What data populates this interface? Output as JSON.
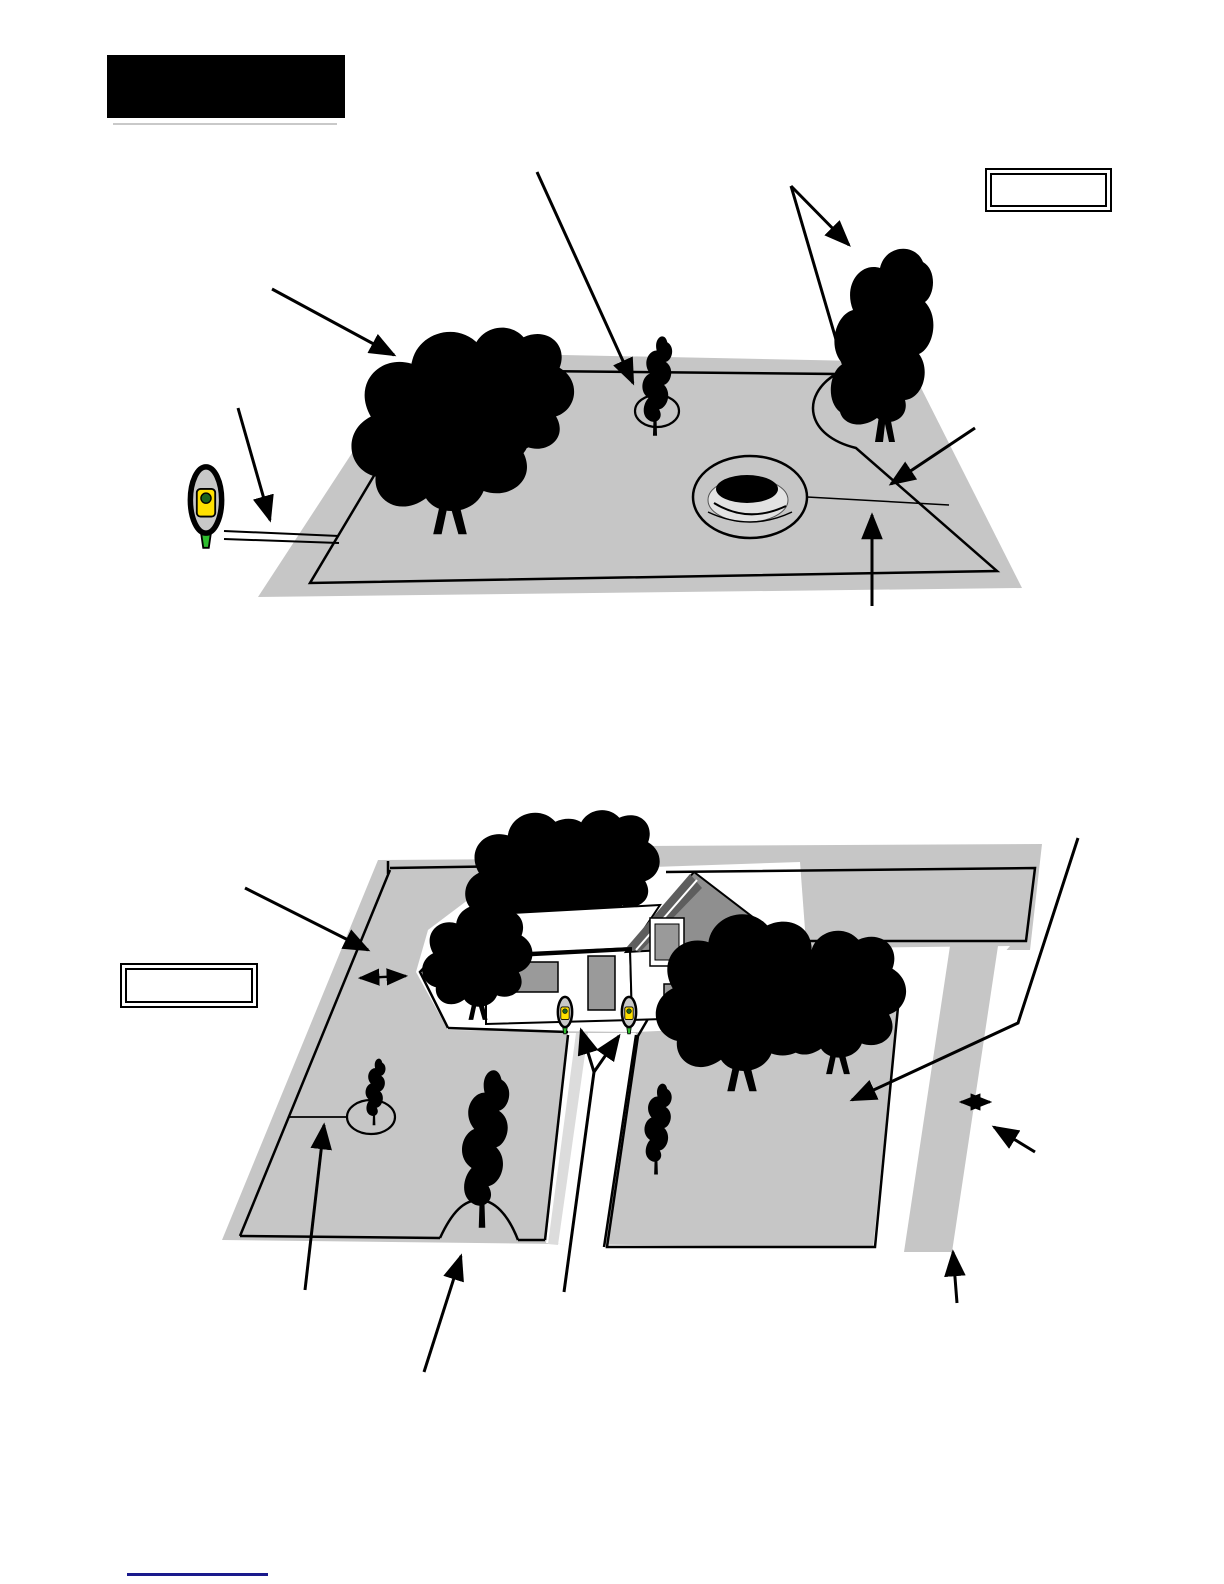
{
  "page": {
    "width": 1224,
    "height": 1584,
    "background": "#ffffff"
  },
  "header": {
    "label": "",
    "background": "#000000"
  },
  "callouts": {
    "upper_right": "",
    "mid_left": ""
  },
  "footer": {
    "rule_color": "#1a1a8c"
  },
  "colors": {
    "lawn_gray": "#c6c6c6",
    "outline_black": "#000000",
    "station_body_yellow": "#ffe000",
    "station_stake_green": "#2ebd2e",
    "station_dot_green": "#1c641c",
    "station_cap_gray": "#c8c8c8",
    "house_wall_white": "#ffffff",
    "gable_gray": "#8f8f8f",
    "roof_edge_dark": "#5e5e5e",
    "window_gray": "#9a9a9a",
    "driveway_stripe": "#dcdcdc",
    "tree_black": "#000000"
  },
  "upper_diagram": {
    "name": "open-lawn-perimeter-wire",
    "elements": [
      "charging-station-icon",
      "lead-wire-pair",
      "perimeter-wire-loop",
      "tree-cluster",
      "tree-island-loop",
      "corner-tree-loop",
      "flower-bed-island",
      "island-connector-wire",
      "annotation-arrows"
    ]
  },
  "lower_diagram": {
    "name": "house-yard-perimeter-wire",
    "elements": [
      "house",
      "driveway",
      "left-lawn-zone",
      "right-lawn-zone",
      "back-lawn-strip",
      "side-path",
      "tree-island-loop",
      "island-connector-wire",
      "tree-trunk-loop",
      "boundary-post-icons",
      "distance-double-arrows",
      "annotation-arrows"
    ]
  }
}
